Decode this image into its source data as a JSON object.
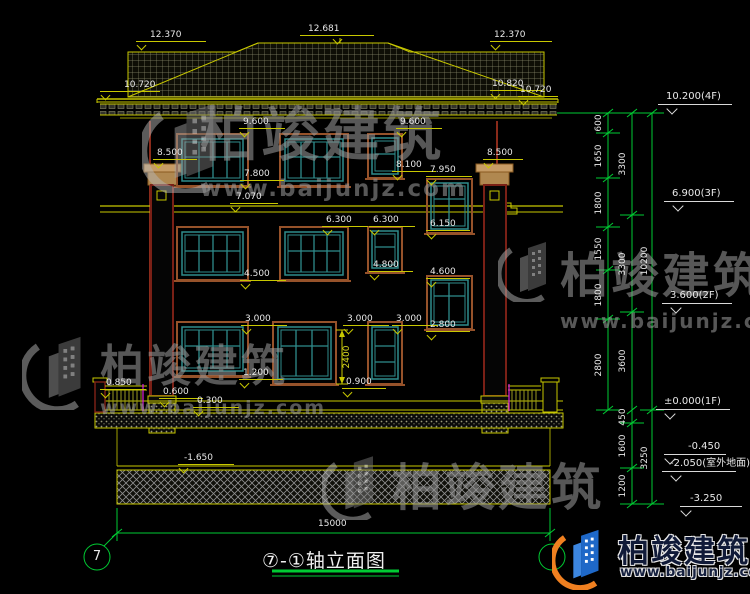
{
  "meta": {
    "title": "⑦-①轴立面图",
    "axis_left": "7",
    "total_width_dim": "15000"
  },
  "watermark": {
    "name": "柏竣建筑",
    "url": "www.baijunjz.com"
  },
  "brand": {
    "name": "柏竣建筑",
    "url": "www.baijunjz.com"
  },
  "colors": {
    "background": "#000000",
    "cad_yellow": "#c8c800",
    "cad_green": "#00cc33",
    "window_teal": "#2f8c8c",
    "trim_brown": "#96522a",
    "wall_maroon": "#8a2a1a",
    "accent_magenta": "#e020e0",
    "brand_blue": "#1e68c8",
    "brand_orange": "#f08020"
  },
  "labels": [
    {
      "t": "12.370",
      "x": 150,
      "y": 30,
      "rw": 70,
      "rx": -14,
      "tx": 2
    },
    {
      "t": "12.681",
      "x": 308,
      "y": 24,
      "rw": 74,
      "rx": -8,
      "tx": 34
    },
    {
      "t": "12.370",
      "x": 494,
      "y": 30,
      "rw": 62,
      "rx": -4,
      "tx": 2
    },
    {
      "t": "10.720",
      "x": 124,
      "y": 80,
      "rw": 60,
      "rx": -24,
      "tx": 2
    },
    {
      "t": "10.820",
      "x": 492,
      "y": 79,
      "rw": 52,
      "rx": -2,
      "tx": 2
    },
    {
      "t": "10.720",
      "x": 520,
      "y": 85,
      "rw": 40,
      "rx": -2,
      "tx": 2
    },
    {
      "t": "9.600",
      "x": 243,
      "y": 117,
      "rw": 46,
      "rx": -4,
      "tx": 2
    },
    {
      "t": "9.600",
      "x": 400,
      "y": 117,
      "rw": 46,
      "rx": -4,
      "tx": 2
    },
    {
      "t": "8.500",
      "x": 157,
      "y": 148,
      "rw": 44,
      "rx": -4,
      "tx": 2
    },
    {
      "t": "8.500",
      "x": 487,
      "y": 148,
      "rw": 40,
      "rx": -4,
      "tx": 2
    },
    {
      "t": "8.100",
      "x": 396,
      "y": 160,
      "rw": 44,
      "rx": -4,
      "tx": 2
    },
    {
      "t": "7.950",
      "x": 430,
      "y": 165,
      "rw": 46,
      "rx": -4,
      "tx": 2
    },
    {
      "t": "7.800",
      "x": 244,
      "y": 169,
      "rw": 44,
      "rx": -4,
      "tx": 2
    },
    {
      "t": "7.070",
      "x": 236,
      "y": 192,
      "rw": 48,
      "rx": -6,
      "tx": 2
    },
    {
      "t": "6.300",
      "x": 326,
      "y": 215,
      "rw": 46,
      "rx": -4,
      "tx": 2
    },
    {
      "t": "6.300",
      "x": 373,
      "y": 215,
      "rw": 46,
      "rx": -4,
      "tx": 2
    },
    {
      "t": "6.150",
      "x": 430,
      "y": 219,
      "rw": 44,
      "rx": -4,
      "tx": 2
    },
    {
      "t": "4.500",
      "x": 244,
      "y": 269,
      "rw": 46,
      "rx": -4,
      "tx": 2
    },
    {
      "t": "4.800",
      "x": 373,
      "y": 260,
      "rw": 44,
      "rx": -4,
      "tx": 2
    },
    {
      "t": "4.600",
      "x": 430,
      "y": 267,
      "rw": 44,
      "rx": -4,
      "tx": 2
    },
    {
      "t": "3.000",
      "x": 245,
      "y": 314,
      "rw": 46,
      "rx": -4,
      "tx": 2
    },
    {
      "t": "3.000",
      "x": 347,
      "y": 314,
      "rw": 46,
      "rx": -4,
      "tx": 2
    },
    {
      "t": "3.000",
      "x": 396,
      "y": 314,
      "rw": 46,
      "rx": -4,
      "tx": 2
    },
    {
      "t": "2.800",
      "x": 430,
      "y": 320,
      "rw": 44,
      "rx": -4,
      "tx": 2
    },
    {
      "t": "1.200",
      "x": 243,
      "y": 368,
      "rw": 44,
      "rx": -4,
      "tx": 2
    },
    {
      "t": "0.900",
      "x": 346,
      "y": 377,
      "rw": 44,
      "rx": -4,
      "tx": 2
    },
    {
      "t": "0.850",
      "x": 106,
      "y": 378,
      "rw": 46,
      "rx": -6,
      "tx": 2
    },
    {
      "t": "0.600",
      "x": 163,
      "y": 387,
      "rw": 44,
      "rx": -4,
      "tx": 2
    },
    {
      "t": "0.300",
      "x": 197,
      "y": 396,
      "rw": 46,
      "rx": -4,
      "tx": 2
    },
    {
      "t": "-1.650",
      "x": 184,
      "y": 453,
      "rw": 56,
      "rx": -6,
      "tx": 2
    },
    {
      "t": "2400",
      "x": 347,
      "y": 357,
      "rot": 1,
      "c": "y"
    },
    {
      "t": "600",
      "x": 599,
      "y": 123,
      "rot": 1
    },
    {
      "t": "1650",
      "x": 599,
      "y": 156,
      "rot": 1
    },
    {
      "t": "1800",
      "x": 599,
      "y": 203,
      "rot": 1
    },
    {
      "t": "1550",
      "x": 599,
      "y": 249,
      "rot": 1
    },
    {
      "t": "1800",
      "x": 599,
      "y": 295,
      "rot": 1
    },
    {
      "t": "2800",
      "x": 599,
      "y": 365,
      "rot": 1
    },
    {
      "t": "3300",
      "x": 623,
      "y": 164,
      "rot": 1
    },
    {
      "t": "3300",
      "x": 623,
      "y": 264,
      "rot": 1
    },
    {
      "t": "3600",
      "x": 623,
      "y": 361,
      "rot": 1
    },
    {
      "t": "450",
      "x": 623,
      "y": 417,
      "rot": 1
    },
    {
      "t": "1600",
      "x": 623,
      "y": 446,
      "rot": 1
    },
    {
      "t": "1200",
      "x": 623,
      "y": 486,
      "rot": 1
    },
    {
      "t": "10200",
      "x": 645,
      "y": 261,
      "rot": 1
    },
    {
      "t": "3250",
      "x": 645,
      "y": 458,
      "rot": 1
    },
    {
      "t": "10.200(4F)",
      "x": 666,
      "y": 92,
      "rw": 74,
      "rx": -8,
      "tx": 10,
      "big": 1
    },
    {
      "t": "6.900(3F)",
      "x": 672,
      "y": 189,
      "rw": 70,
      "rx": -8,
      "tx": 10,
      "big": 1
    },
    {
      "t": "3.600(2F)",
      "x": 670,
      "y": 291,
      "rw": 70,
      "rx": -8,
      "tx": 10,
      "big": 1
    },
    {
      "t": "±0.000(1F)",
      "x": 664,
      "y": 397,
      "rw": 74,
      "rx": -8,
      "tx": 10,
      "big": 1
    },
    {
      "t": "-0.450",
      "x": 688,
      "y": 442,
      "rw": 62,
      "rx": -24,
      "tx": 2,
      "big": 1
    },
    {
      "t": "-2.050(室外地面)",
      "x": 670,
      "y": 459,
      "rw": 74,
      "rx": -8,
      "tx": 10,
      "big": 1
    },
    {
      "t": "-3.250",
      "x": 690,
      "y": 494,
      "rw": 62,
      "rx": -10,
      "tx": 2,
      "big": 1
    },
    {
      "t": "15000",
      "x": 318,
      "y": 519,
      "plain": 1
    },
    {
      "t": "7",
      "x": 97,
      "y": 557,
      "plain": 1,
      "ctr": 1,
      "fs": 13
    }
  ]
}
